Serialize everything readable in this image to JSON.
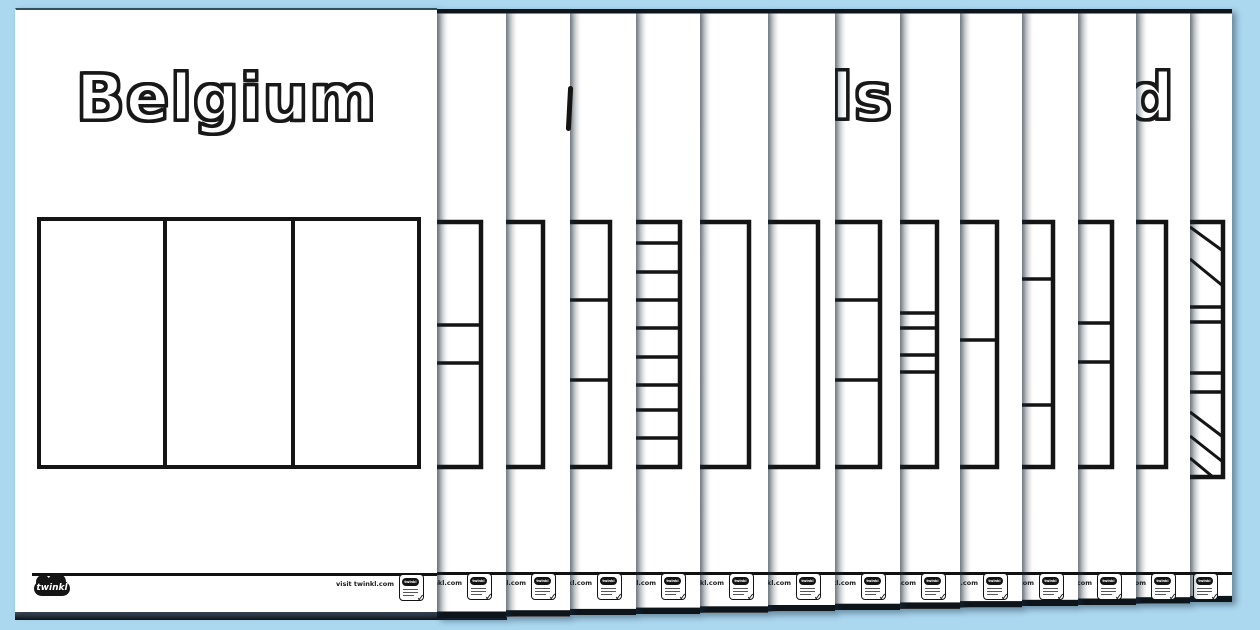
{
  "colors": {
    "background": "#abd7ef",
    "page": "#ffffff",
    "ink": "#141414",
    "stack_edge_dark": "#0d141a"
  },
  "footer": {
    "visit_text": "visit twinkl.com",
    "brand": "twinkl",
    "stamp_brand": "twinkl"
  },
  "pages": [
    {
      "n": 1,
      "title": "Belgium",
      "page_left": 15,
      "page_right": 437,
      "page_top": 8,
      "page_bottom": 612,
      "flag": {
        "left": 36,
        "right": 420,
        "top": 215,
        "bottom": 467,
        "vlines": [
          164,
          292
        ],
        "hint": "vertical tricolour outline"
      }
    },
    {
      "n": 2,
      "page_right": 506,
      "flag": {
        "right": 481,
        "top": 222,
        "bottom": 467,
        "hlines": [
          325,
          363
        ],
        "hint": "horizontal cross-arm band"
      }
    },
    {
      "n": 3,
      "page_right": 570,
      "title_sliver": {
        "x": 567,
        "y": 86,
        "w": 5,
        "h": 45
      },
      "flag": {
        "right": 543,
        "top": 222,
        "bottom": 467,
        "hlines": [],
        "hint": "plain right edge"
      }
    },
    {
      "n": 4,
      "page_right": 636,
      "flag": {
        "right": 610,
        "top": 222,
        "bottom": 467,
        "hlines": [
          300,
          380
        ],
        "hint": "horizontal tricolour"
      }
    },
    {
      "n": 5,
      "page_right": 700,
      "flag": {
        "right": 680,
        "top": 222,
        "bottom": 467,
        "hlines": [
          243,
          272,
          300,
          328,
          357,
          385,
          410,
          438
        ],
        "hint": "nine horizontal stripes"
      }
    },
    {
      "n": 6,
      "page_right": 768,
      "flag": {
        "right": 749,
        "top": 222,
        "bottom": 467,
        "hlines": [],
        "hint": "plain right edge"
      }
    },
    {
      "n": 7,
      "page_right": 835,
      "flag": {
        "right": 818,
        "top": 222,
        "bottom": 467,
        "hlines": [],
        "hint": "plain right edge"
      }
    },
    {
      "n": 8,
      "page_right": 900,
      "title_fragment": "ls",
      "title_fragment_x": 831,
      "flag": {
        "right": 880,
        "top": 222,
        "bottom": 467,
        "hlines": [
          300,
          380
        ],
        "hint": "horizontal tricolour"
      }
    },
    {
      "n": 9,
      "page_right": 960,
      "flag": {
        "right": 937,
        "top": 222,
        "bottom": 467,
        "hlines": [
          313,
          328,
          355,
          372
        ],
        "hint": "central band with thin borders"
      }
    },
    {
      "n": 10,
      "page_right": 1022,
      "flag": {
        "right": 997,
        "top": 222,
        "bottom": 467,
        "hlines": [
          340
        ],
        "hint": "two horizontal halves"
      }
    },
    {
      "n": 11,
      "page_right": 1078,
      "flag": {
        "right": 1053,
        "top": 222,
        "bottom": 467,
        "hlines": [
          279,
          405
        ],
        "hint": "wide central band"
      }
    },
    {
      "n": 12,
      "page_right": 1136,
      "flag": {
        "right": 1112,
        "top": 222,
        "bottom": 467,
        "hlines": [
          323,
          362
        ],
        "hint": "horizontal cross-arm band"
      }
    },
    {
      "n": 13,
      "page_right": 1190,
      "title_fragment": "d",
      "title_fragment_x": 1128,
      "flag": {
        "right": 1166,
        "top": 222,
        "bottom": 467,
        "hlines": [],
        "hint": "plain right edge"
      }
    },
    {
      "n": 14,
      "page_right": 1232,
      "flag": {
        "right": 1223,
        "top": 222,
        "bottom": 477,
        "hlines": [
          307,
          322,
          373,
          392
        ],
        "diagonals": [
          [
            1190,
            227,
            1223,
            251
          ],
          [
            1190,
            259,
            1223,
            286
          ],
          [
            1190,
            412,
            1223,
            437
          ],
          [
            1190,
            436,
            1223,
            462
          ],
          [
            1190,
            458,
            1213,
            477
          ]
        ],
        "hint": "union-jack right edge"
      }
    }
  ]
}
